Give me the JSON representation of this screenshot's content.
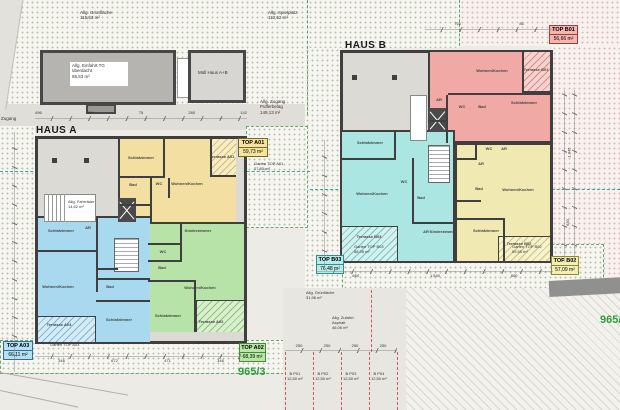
{
  "site": {
    "green_top": {
      "label": "Allg. Grünfläche",
      "area": "115,53 m²"
    },
    "playground": {
      "label": "Allg. Spielplatz",
      "area": "110,52 m²"
    },
    "garage": {
      "line1": "Allg. Einfahrt TG",
      "line2": "überdacht",
      "area": "55,53 m²"
    },
    "waste": {
      "label": "Müll Haus A+B"
    },
    "access_path": {
      "line1": "Allg. Zugang",
      "line2": "Pufferbelag",
      "area": "149,13 m²"
    },
    "bikes": {
      "label": "Allg. Fahrräder",
      "area": "14,62 m²"
    },
    "green_bottom": {
      "label": "Allg. Grünfläche",
      "area": "31,96 m²"
    },
    "driveway": {
      "line1": "Allg. Zufahrt",
      "line2": "Asphalt",
      "area": "46,06 m²"
    },
    "access_small": "Zugang",
    "parcel_number": "965/3",
    "parcel_number_right": "965/4",
    "parking": {
      "stalls": [
        {
          "id": "B P01",
          "area": "12,50 m²"
        },
        {
          "id": "B P02",
          "area": "12,50 m²"
        },
        {
          "id": "B P03",
          "area": "12,50 m²"
        },
        {
          "id": "B P04",
          "area": "12,50 m²"
        }
      ]
    }
  },
  "haus_a": {
    "name": "HAUS A",
    "apartments": [
      {
        "id": "TOP A01",
        "area": "59,73 m²",
        "garden": {
          "label": "Garten TOP A01",
          "area": "27,80 m²"
        },
        "rooms": [
          "Schlafzimmer",
          "Bad",
          "WC",
          "Wohnen/Kochen",
          "Terrasse A01"
        ]
      },
      {
        "id": "TOP A02",
        "area": "68,39 m²",
        "garden": {
          "label": "Garten TOP A02"
        },
        "rooms": [
          "Kinderzimmer",
          "WC",
          "Bad",
          "Wohnen/Kochen",
          "Schlafzimmer",
          "Terrasse A02"
        ]
      },
      {
        "id": "TOP A03",
        "area": "66,11 m²",
        "garden": {
          "label": "Garten TOP A03"
        },
        "rooms": [
          "Schlafzimmer",
          "AR",
          "Wohnen/Kochen",
          "Bad",
          "Schlafzimmer",
          "Terrasse A03"
        ]
      }
    ]
  },
  "haus_b": {
    "name": "HAUS B",
    "apartments": [
      {
        "id": "TOP B01",
        "area": "56,66 m²",
        "rooms": [
          "Wohnen/Kochen",
          "Terrasse B01",
          "Schlafzimmer",
          "Bad",
          "WC",
          "AR"
        ]
      },
      {
        "id": "TOP B02",
        "area": "57,09 m²",
        "garden": {
          "label": "Garten TOP B02",
          "area": "59,55 m²"
        },
        "rooms": [
          "WC",
          "AR",
          "AR",
          "Bad",
          "Wohnen/Kochen",
          "Schlafzimmer",
          "Terrasse B02"
        ]
      },
      {
        "id": "TOP B03",
        "area": "76,48 m²",
        "garden": {
          "label": "Garten TOP B03",
          "area": "88,95 m²"
        },
        "rooms": [
          "Schlafzimmer",
          "Wohnen/Kochen",
          "WC",
          "Bad",
          "AR",
          "Kinderzimmer",
          "Terrasse B03"
        ]
      }
    ]
  },
  "dims": {
    "a_top": [
      "496",
      "401",
      "75",
      "260",
      "142"
    ],
    "b_top": [
      "755",
      "85"
    ],
    "a_bottom": [
      "346",
      "672",
      "471",
      "346"
    ],
    "b_bottom": [
      "660",
      "1.540",
      "660"
    ],
    "right_side": [
      "1.345",
      "630"
    ],
    "parking": [
      "250",
      "250",
      "250",
      "250"
    ]
  }
}
